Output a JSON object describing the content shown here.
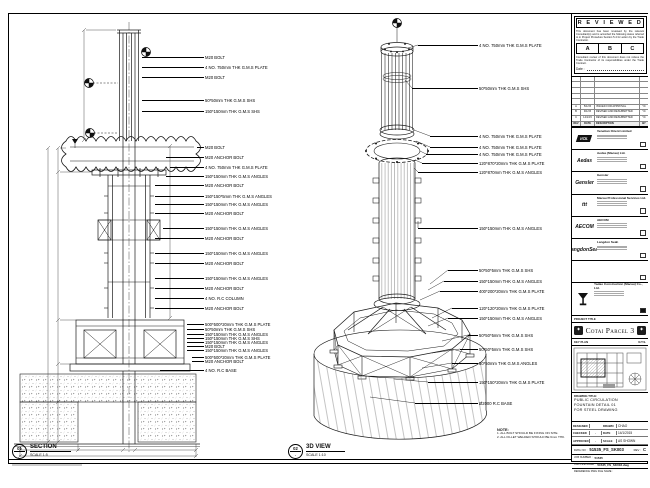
{
  "colors": {
    "line": "#1b1b1b",
    "sheet": "#ffffff",
    "stamp": "#000000"
  },
  "margin_note": "DO NOT SCALE DRAWING. VERIFY ALL DIMENSIONS ON SITE.",
  "reviewed": {
    "title": "R E V I E W E D",
    "para1": "This document has been reviewed by the relevant Consultant(s) and is accorded the following status referred to in Project Procedure Section 5.4 for action by the Trade Contractor.",
    "statuses": [
      "A",
      "B",
      "C"
    ],
    "para2": "Consultant review of this document does not relieve the Trade Contractor of its responsibilities under the Trade Contract.",
    "date_label": "Date :"
  },
  "revision_table": {
    "headers": [
      "REV",
      "DATE",
      "DESCRIPTION",
      "BY"
    ],
    "rows": [
      {
        "rev": "A",
        "date": "5/1/15",
        "desc": "ISSUED FOR APPROVAL",
        "by": "YC"
      },
      {
        "rev": "B",
        "date": "9/1/15",
        "desc": "REVISED AND RESUBMITTED",
        "by": "YC"
      },
      {
        "rev": "C",
        "date": "14/1/15",
        "desc": "REVISED AND RESUBMITTED",
        "by": "YC"
      }
    ]
  },
  "consultants": [
    {
      "logo_text": "VOL",
      "name": "Venetian Orient Limited"
    },
    {
      "logo_text": "Aedas",
      "name": "Aedas (Macau) Ltd."
    },
    {
      "logo_text": "Gensler",
      "name": "Gensler"
    },
    {
      "logo_text": "ttt",
      "name": "Macau Professional Services Ltd."
    },
    {
      "logo_text": "AECOM",
      "name": "AECOM"
    },
    {
      "logo_text": "LangdonSeah",
      "name": "Langdon Seah"
    },
    {
      "logo_text": "",
      "name": ""
    }
  ],
  "contractor": {
    "name": "Yadao Construction (Macau) Co., Ltd."
  },
  "project": {
    "label": "PROJECT TITLE",
    "title": "Cotai Parcel 3"
  },
  "key_plan": {
    "label": "KEY PLAN",
    "scale": "N.T.S."
  },
  "drawing_title": {
    "label": "DRAWING TITLE:",
    "lines": [
      "PUBLIC CIRCULATION",
      "FOUNTAIN DETAIL 01",
      "FOR STEEL DRAWING"
    ]
  },
  "fields": {
    "designed_label": "DESIGNED",
    "designed": "",
    "drawn_label": "DRAWN",
    "drawn": "CHAO",
    "checked_label": "CHECKED",
    "checked": "-",
    "date_label": "DATE",
    "date": "14/1/2015",
    "approved_label": "APPROVED",
    "approved": "-",
    "scale_label": "SCALE",
    "scale": "AS SHOWN"
  },
  "doc_numbers": {
    "dwg_label": "DWG NO :",
    "dwg_no": "51535_FS_SK003",
    "rev_label": "REV :",
    "rev": "C",
    "job_label": "JOB NUMBER :",
    "job_no": "51535",
    "cad_label": "CAD FILE NAME :",
    "cad_file": "51535_FS_SK003.dwg",
    "ref_label": "REFERENCE DWG FILE NAME :",
    "ref_file": ""
  },
  "section_view": {
    "bubble": "01",
    "bubble_den": "-",
    "title": "SECTION",
    "scale": "SCALE 1:5",
    "callouts": [
      {
        "y": 57,
        "text": "M20 BOLT"
      },
      {
        "y": 67,
        "text": "4 NO. 750mm THK G.M.S PLATE"
      },
      {
        "y": 77,
        "text": "M20 BOLT"
      },
      {
        "y": 100,
        "text": "50*50mm THK G.M.S SHS"
      },
      {
        "y": 111,
        "text": "150*150mm THK G.M.S SHS"
      },
      {
        "y": 147,
        "sx": 197,
        "text": "M20 BOLT"
      },
      {
        "y": 157,
        "sx": 166,
        "text": "M20 ANCHOR BOLT"
      },
      {
        "y": 167,
        "sx": 170,
        "text": "4 NO. 750mm THK G.M.S PLATE"
      },
      {
        "y": 176,
        "sx": 166,
        "text": "150*150mm THK G.M.S ANGLES"
      },
      {
        "y": 185,
        "sx": 155,
        "text": "M20 ANCHOR BOLT"
      },
      {
        "y": 196,
        "sx": 155,
        "text": "150*150*5mm THK G.M.S ANGLES"
      },
      {
        "y": 204,
        "sx": 155,
        "text": "150*150mm THK G.M.S ANGLES"
      },
      {
        "y": 213,
        "sx": 155,
        "text": "M20 ANCHOR BOLT"
      },
      {
        "y": 228,
        "sx": 163,
        "text": "150*150mm THK G.M.S ANGLES"
      },
      {
        "y": 238,
        "sx": 155,
        "text": "M20 ANCHOR BOLT"
      },
      {
        "y": 253,
        "sx": 155,
        "text": "150*150mm THK G.M.S ANGLES"
      },
      {
        "y": 263,
        "sx": 155,
        "text": "M20 ANCHOR BOLT"
      },
      {
        "y": 278,
        "sx": 155,
        "text": "150*150mm THK G.M.S ANGLES"
      },
      {
        "y": 288,
        "sx": 155,
        "text": "M20 ANCHOR BOLT"
      },
      {
        "y": 298,
        "sx": 155,
        "text": "4 NO. R.C COLUMN"
      },
      {
        "y": 308,
        "sx": 155,
        "text": "M20 ANCHOR BOLT"
      },
      {
        "y": 324,
        "sx": 187,
        "text": "500*500*20mm THK G.M.S PLATE"
      },
      {
        "y": 329,
        "sx": 187,
        "text": "50*50mm THK G.M.S SHS"
      },
      {
        "y": 334,
        "sx": 187,
        "text": "150*150mm THK G.M.S ANGLES"
      },
      {
        "y": 338,
        "sx": 187,
        "text": "150*150mm THK G.M.S SHS"
      },
      {
        "y": 342,
        "sx": 187,
        "text": "150*150mm THK G.M.S ANGLES"
      },
      {
        "y": 346,
        "sx": 187,
        "text": "M20 BOLT"
      },
      {
        "y": 350,
        "sx": 187,
        "text": "150*150mm THK G.M.S ANGLES"
      },
      {
        "y": 357,
        "sx": 192,
        "text": "500*500*20mm THK G.M.S PLATE"
      },
      {
        "y": 361,
        "sx": 192,
        "text": "M20 ANCHOR BOLT"
      },
      {
        "y": 370,
        "sx": 160,
        "text": "4 NO. R.C BASE"
      }
    ]
  },
  "iso_view": {
    "bubble": "02",
    "bubble_den": "-",
    "title": "3D VIEW",
    "scale": "SCALE 1:10",
    "callouts": [
      {
        "y": 45,
        "sx": 418,
        "text": "4 NO. 750mm THK G.M.S PLATE"
      },
      {
        "y": 88,
        "sx": 412,
        "text": "50*50mm THK G.M.S SHS"
      },
      {
        "y": 136,
        "sx": 430,
        "text": "4 NO. 750mm THK G.M.S PLATE"
      },
      {
        "y": 147,
        "sx": 430,
        "text": "4 NO. 750mm THK G.M.S PLATE"
      },
      {
        "y": 154,
        "sx": 426,
        "text": "4 NO. 750mm THK G.M.S PLATE"
      },
      {
        "y": 163,
        "sx": 422,
        "text": "120*870*20mm THK G.M.S PLATE"
      },
      {
        "y": 172,
        "sx": 418,
        "text": "120*870mm THK G.M.S ANGLES"
      },
      {
        "y": 228,
        "sx": 418,
        "text": "150*150mm THK G.M.S ANGLES"
      },
      {
        "y": 270,
        "sx": 448,
        "text": "50*50*5mm THK G.M.S SHS"
      },
      {
        "y": 281,
        "sx": 444,
        "text": "150*150mm THK G.M.S ANGLES"
      },
      {
        "y": 291,
        "sx": 440,
        "text": "400*200*20mm THK G.M.S PLATE"
      },
      {
        "y": 308,
        "sx": 452,
        "text": "120*120*20mm THK G.M.S PLATE"
      },
      {
        "y": 318,
        "sx": 448,
        "text": "150*150mm THK G.M.S ANGLES"
      },
      {
        "y": 335,
        "sx": 468,
        "text": "50*50*5mm THK G.M.S SHS"
      },
      {
        "y": 349,
        "sx": 460,
        "text": "50*50*5mm THK G.M.S SHS"
      },
      {
        "y": 363,
        "sx": 452,
        "text": "50*50mm THK G.M.S ANGLES"
      },
      {
        "y": 382,
        "sx": 428,
        "text": "150*150*20mm THK G.M.S PLATE"
      },
      {
        "y": 403,
        "sx": 415,
        "text": "Ø2000 R.C BASE"
      }
    ],
    "note_title": "NOTE:",
    "notes": [
      "1. ALL BOLT SHOULD BE FIXING ON SITE.",
      "2. ALL FILLET WELDED SHOULD BE 6mm THK."
    ]
  }
}
